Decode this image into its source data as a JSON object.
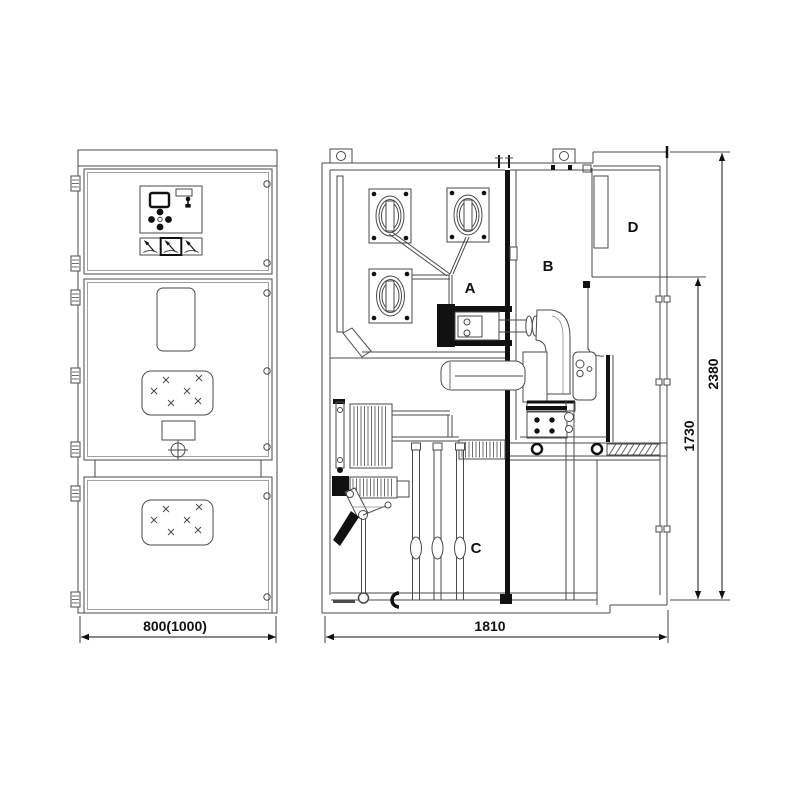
{
  "drawing": {
    "front_view": {
      "width_dimension": "800(1000)"
    },
    "side_view": {
      "width_dimension": "1810",
      "overall_height_dimension": "2380",
      "lower_height_dimension": "1730",
      "compartment_labels": {
        "a": "A",
        "b": "B",
        "c": "C",
        "d": "D"
      }
    }
  }
}
